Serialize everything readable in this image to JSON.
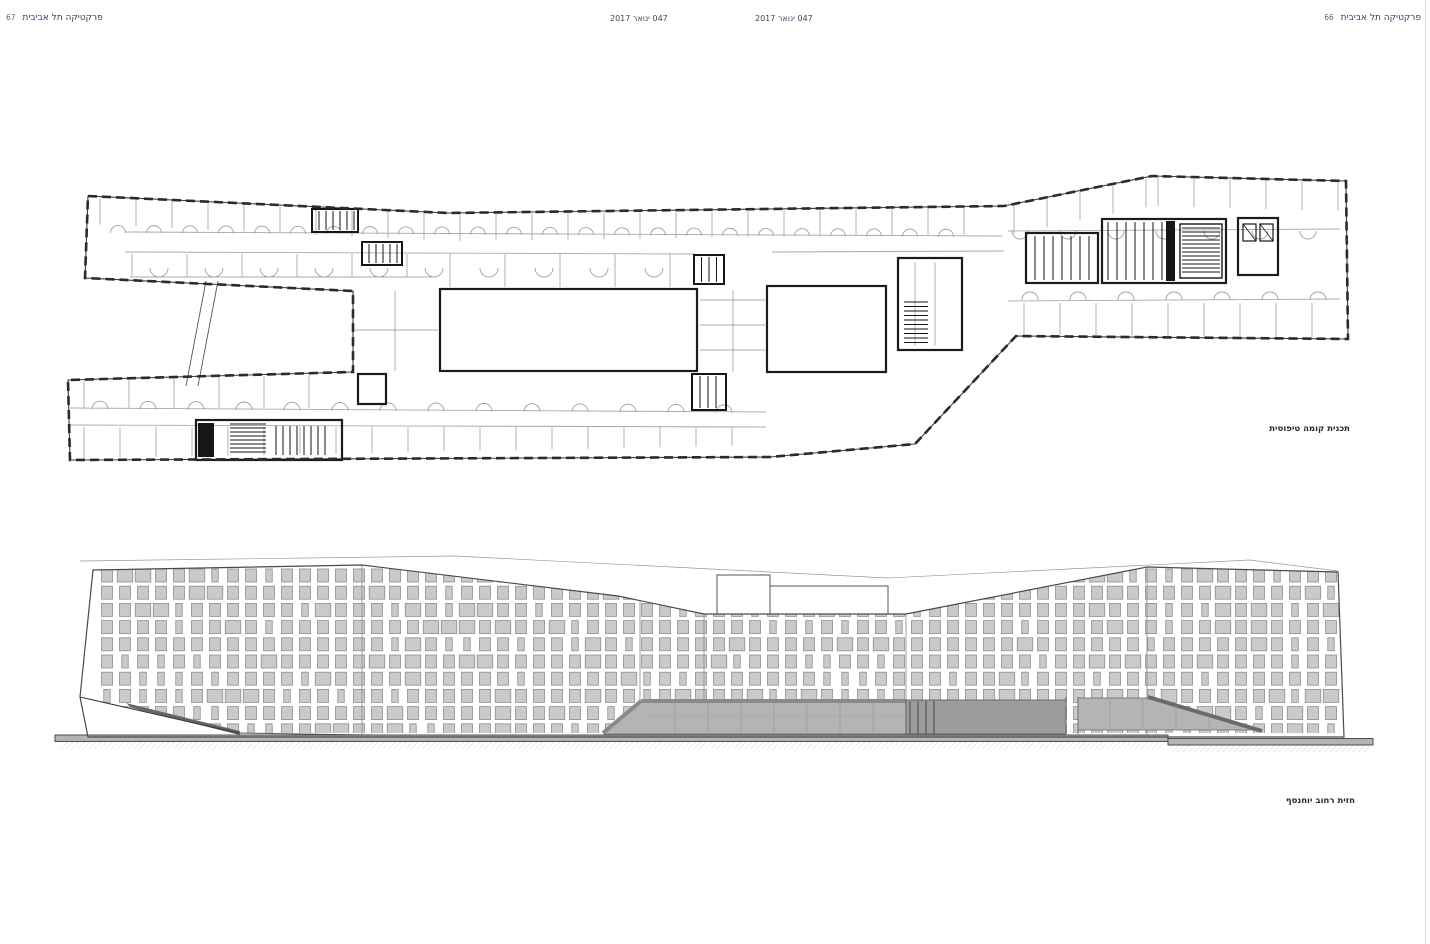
{
  "page": {
    "header_left": {
      "title": "פרקטיקה תל אביבית",
      "page_number": "67"
    },
    "header_right": {
      "title": "פרקטיקה תל אביבית",
      "page_number": "66"
    },
    "issue_left": "047 ינואר 2017",
    "issue_right": "047 ינואר 2017"
  },
  "plan": {
    "caption": "תכנית קומה טיפוסית"
  },
  "elevation": {
    "caption": "חזית רחוב יוחנסף"
  },
  "colors": {
    "header_text": "#33415e",
    "caption_text": "#1f2735",
    "plan_line_dark": "#2b2b2b",
    "plan_line_light": "#a8a8a8",
    "plan_core_black": "#161616",
    "window_fill": "#cacaca",
    "window_border": "#8e8e8e",
    "glazing_fill": "#b4b4b4",
    "glazing_dark": "#8a8a8a",
    "ground_fill": "#b3b3b3",
    "background": "#ffffff"
  }
}
